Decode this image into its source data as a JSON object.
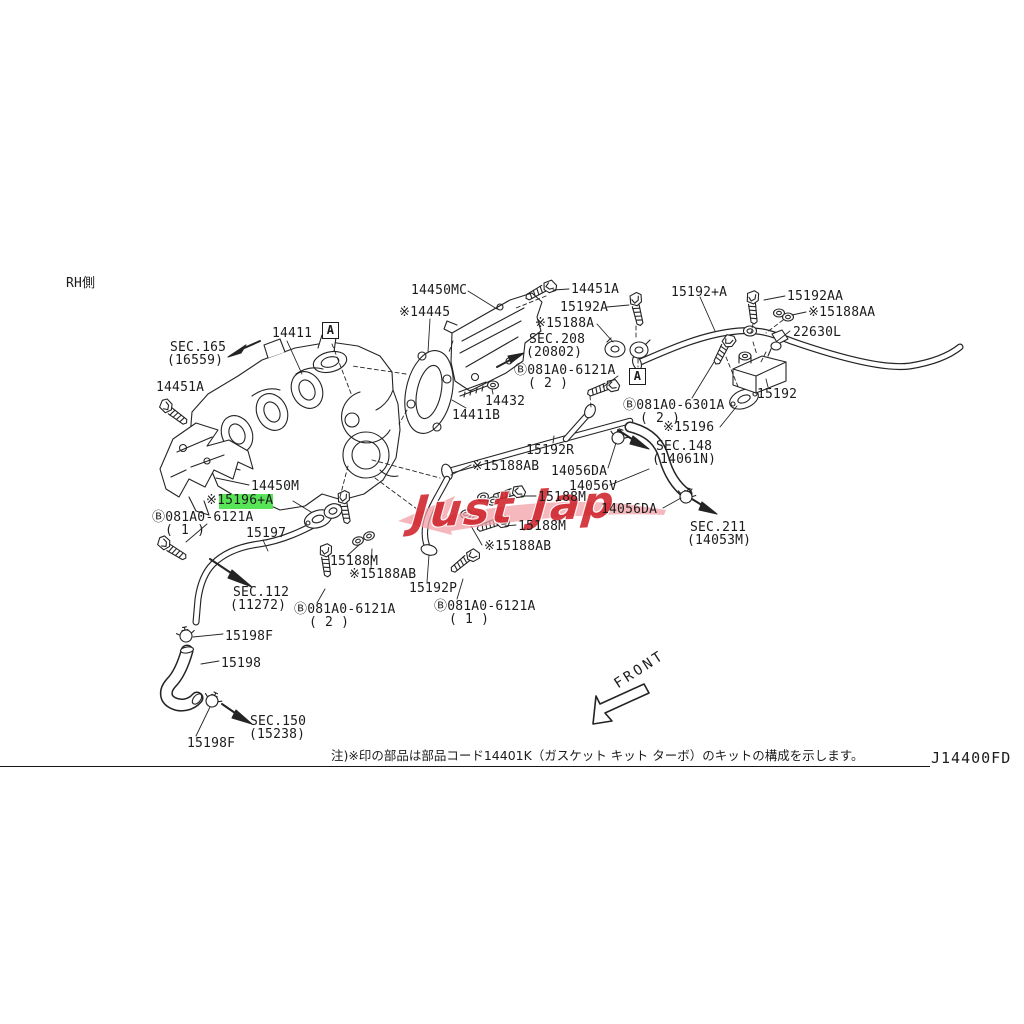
{
  "doc": {
    "side_label": "RH側",
    "front_label": "FRONT",
    "note": "注)※印の部品は部品コード14401K（ガスケット キット ターボ）のキットの構成を示します。",
    "sheet_code": "J14400FD",
    "watermark": "Just Jap"
  },
  "colors": {
    "line": "#242424",
    "highlight": "#57e457",
    "watermark_red": "#d0232b",
    "watermark_pink": "#f2a0a6"
  },
  "callouts": [
    {
      "text": "RH側"
    },
    {
      "text": "SEC.165"
    },
    {
      "text": "(16559)"
    },
    {
      "text": "14411"
    },
    {
      "text": "A"
    },
    {
      "text": "14451A"
    },
    {
      "text": "14450MC"
    },
    {
      "text": "※14445"
    },
    {
      "text": "14451A"
    },
    {
      "text": "15192A"
    },
    {
      "text": "※15188A"
    },
    {
      "text": "SEC.208"
    },
    {
      "text": "(20802)"
    },
    {
      "text": "Ⓑ081A0-6121A"
    },
    {
      "text": "( 2 )"
    },
    {
      "text": "15192+A"
    },
    {
      "text": "15192AA"
    },
    {
      "text": "※15188AA"
    },
    {
      "text": "22630L"
    },
    {
      "text": "A"
    },
    {
      "text": "Ⓑ081A0-6301A"
    },
    {
      "text": "( 2 )"
    },
    {
      "text": "15192"
    },
    {
      "text": "※15196"
    },
    {
      "text": "SEC.148"
    },
    {
      "text": "(14061N)"
    },
    {
      "text": "14432"
    },
    {
      "text": "14411B"
    },
    {
      "text": "15192R"
    },
    {
      "text": "※15188AB"
    },
    {
      "text": "14056DA"
    },
    {
      "text": "14056V"
    },
    {
      "text": "15188M"
    },
    {
      "text": "14056DA"
    },
    {
      "text": "SEC.211"
    },
    {
      "text": "(14053M)"
    },
    {
      "text": "15188M"
    },
    {
      "text": "※15188AB"
    },
    {
      "text": "14450M"
    },
    {
      "text": "※15196+A"
    },
    {
      "text": "Ⓑ081A0-6121A"
    },
    {
      "text": "( 1 )"
    },
    {
      "text": "15197"
    },
    {
      "text": "15188M"
    },
    {
      "text": "※15188AB"
    },
    {
      "text": "15192P"
    },
    {
      "text": "Ⓑ081A0-6121A"
    },
    {
      "text": "( 2 )"
    },
    {
      "text": "Ⓑ081A0-6121A"
    },
    {
      "text": "( 1 )"
    },
    {
      "text": "SEC.112"
    },
    {
      "text": "(11272)"
    },
    {
      "text": "15198F"
    },
    {
      "text": "15198"
    },
    {
      "text": "SEC.150"
    },
    {
      "text": "(15238)"
    },
    {
      "text": "15198F"
    }
  ]
}
